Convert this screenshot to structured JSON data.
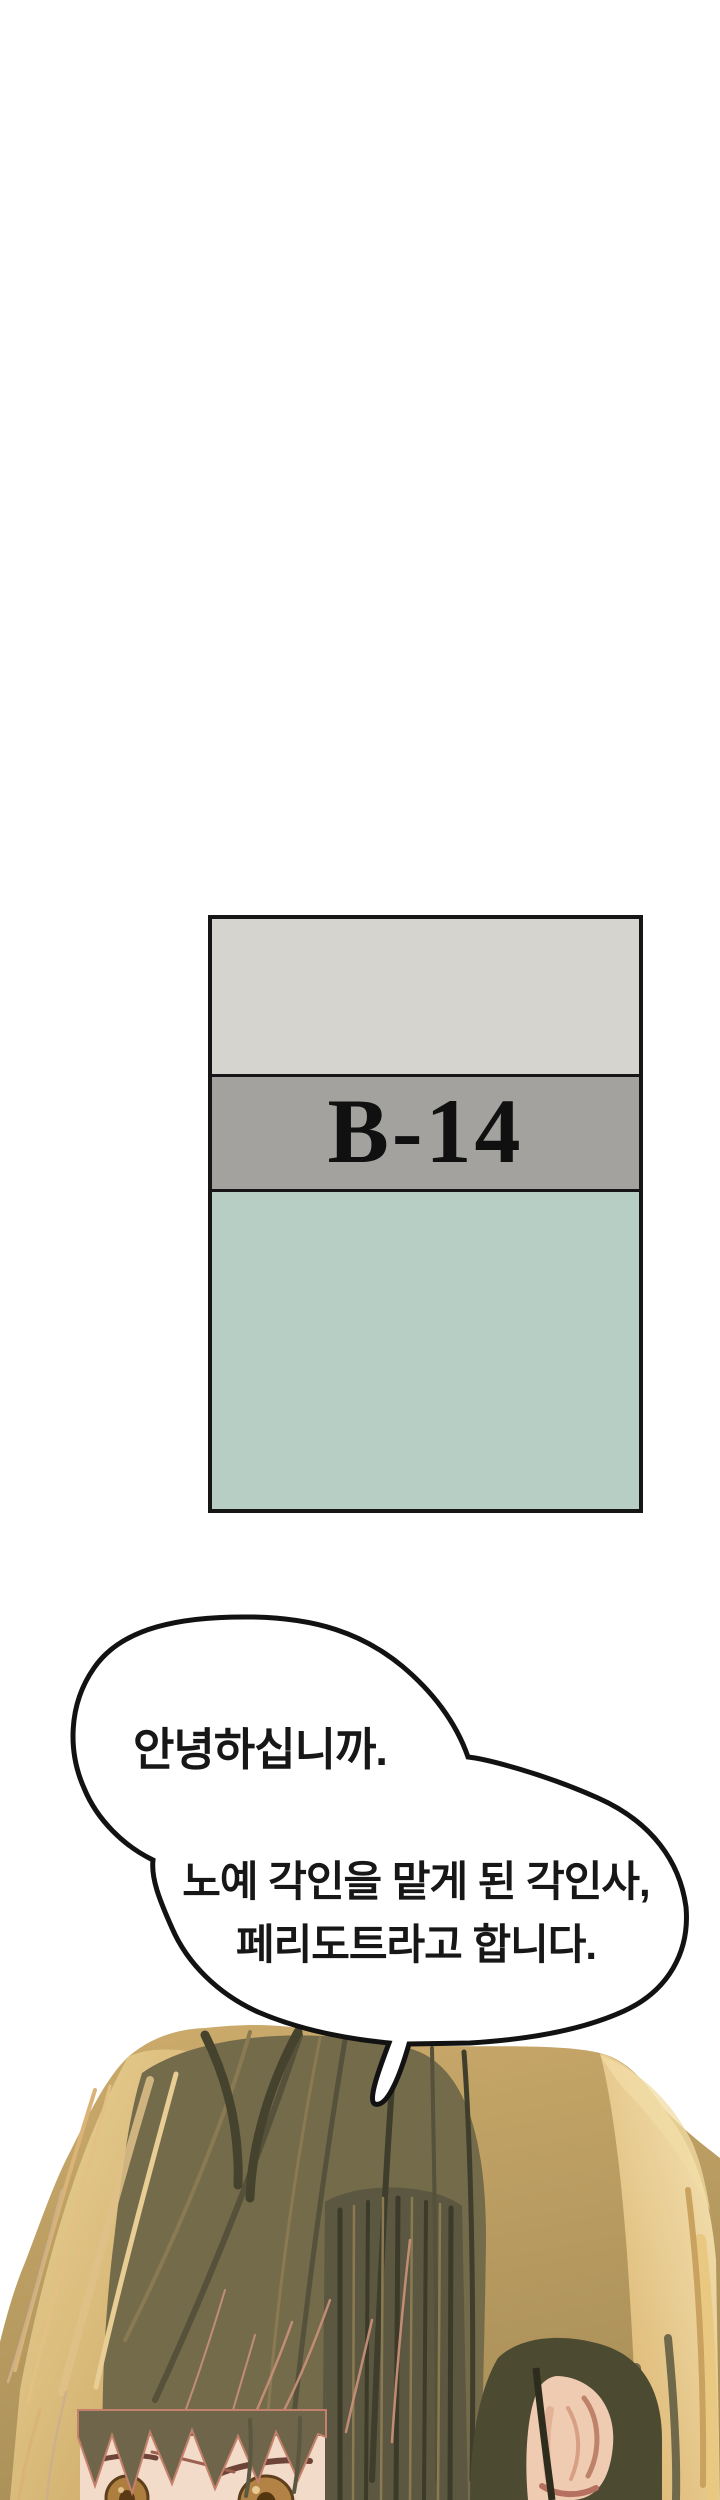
{
  "sign": {
    "label": "B-14"
  },
  "speech_bubble": {
    "greeting": "안녕하십니까.",
    "intro_line1": "노예 각인을 맡게 된 각인사,",
    "intro_line2": "페리도트라고 합니다."
  },
  "colors": {
    "page_bg": "#ffffff",
    "sign_border": "#161616",
    "sign_top_band": "#d6d4ce",
    "sign_label_band": "#a3a29e",
    "sign_bottom_band": "#b6cec3",
    "sign_text": "#101010",
    "bubble_fill": "#ffffff",
    "bubble_outline": "#121212",
    "text_ink": "#171717",
    "hair_base": "#c0a267",
    "hair_gold": "#e9cb8d",
    "hair_olive": "#746b4b",
    "hair_dark": "#3f3d2b",
    "skin": "#f3dbc9",
    "accent_pink": "#c78f78",
    "eye_amber": "#ad7e3d"
  }
}
